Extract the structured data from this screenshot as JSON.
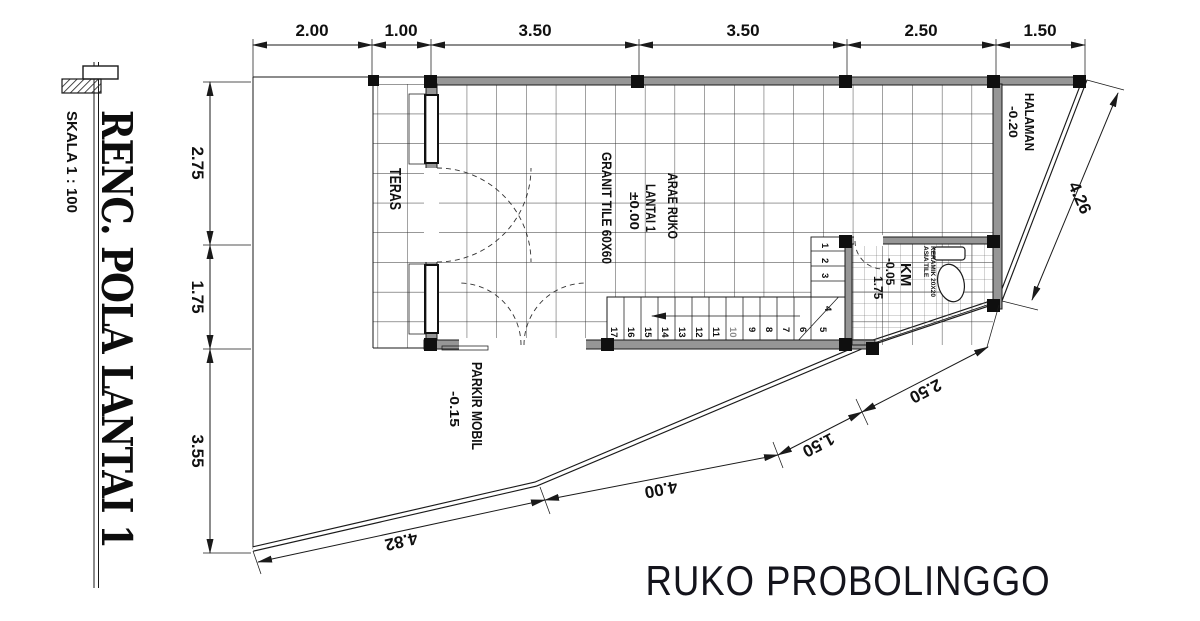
{
  "title_block": {
    "title": "RENC. POLA LANTAI 1",
    "scale": "SKALA 1 : 100"
  },
  "project_title": "RUKO PROBOLINGGO",
  "dimensions": {
    "top": [
      "2.00",
      "1.00",
      "3.50",
      "3.50",
      "2.50",
      "1.50"
    ],
    "left": [
      "2.75",
      "1.75",
      "3.55"
    ],
    "bottom": [
      "4.82",
      "4.00",
      "1.50",
      "2.50"
    ],
    "right_diagonal": "4.26"
  },
  "rooms": {
    "teras": {
      "label": "TERAS"
    },
    "area_ruko": {
      "name_line1": "ARAE RUKO",
      "name_line2": "LANTAI 1",
      "elevation": "±0.00",
      "floor_finish": "GRANIT TILE 60X60"
    },
    "km": {
      "label": "KM",
      "elevation": "-0.05",
      "width_dim": "1.75",
      "tile_line1": "ASIA TILE",
      "tile_line2": "KERAMIK 20X20"
    },
    "halaman": {
      "label": "HALAMAN",
      "elevation": "-0.20"
    },
    "parkir": {
      "label": "PARKIR MOBIL",
      "elevation": "-0.15"
    }
  },
  "stairs": {
    "numbers_run": [
      "17",
      "16",
      "15",
      "14",
      "13",
      "12",
      "11",
      "10",
      "9",
      "8",
      "7",
      "6",
      "5"
    ],
    "numbers_winder": [
      "1",
      "2",
      "3",
      "4"
    ]
  },
  "colors": {
    "line": "#1a1a1a",
    "wall_fill": "#969696",
    "text": "#101010",
    "title_text": "#14141c"
  }
}
